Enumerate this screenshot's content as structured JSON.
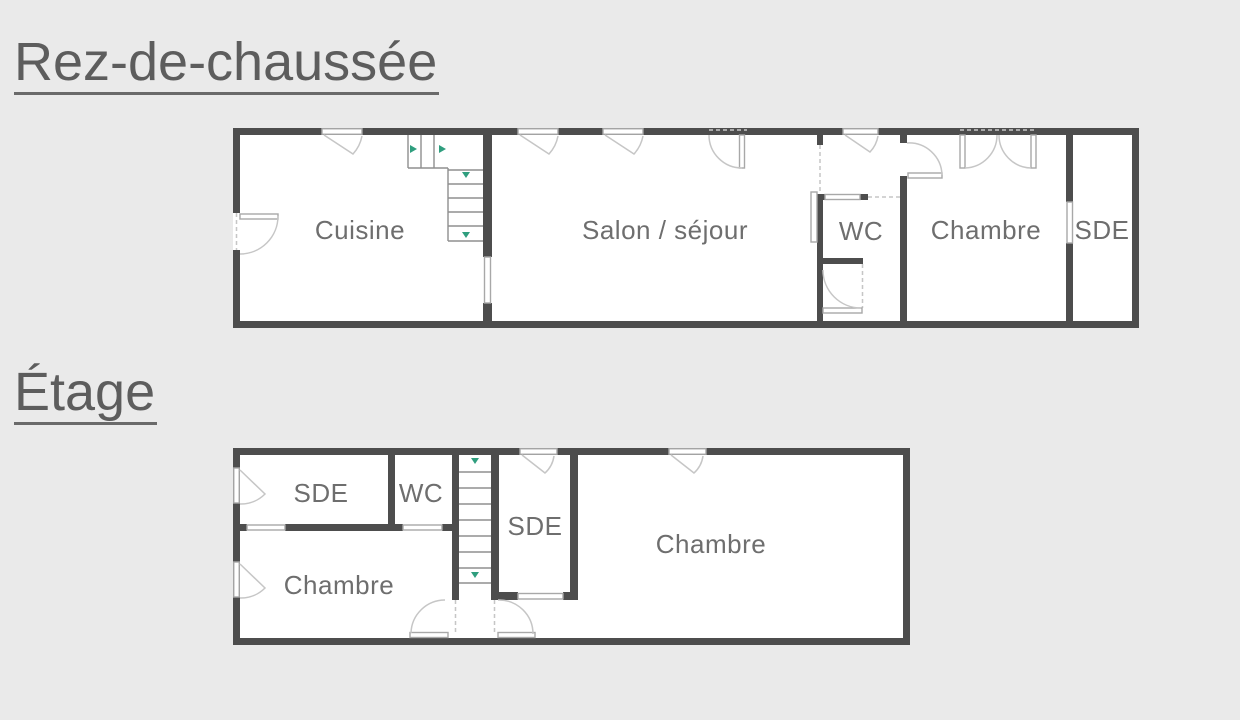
{
  "palette": {
    "background": "#eaeaea",
    "wall": "#4d4d4d",
    "room_fill": "#ffffff",
    "label_text": "#6e6e6e",
    "title_text": "#5d5d5d",
    "door_line": "#c6c6c6",
    "stair_tread": "#8f8f8f",
    "direction_arrow": "#2f9e7e",
    "window_border": "#a8a8a8"
  },
  "floors": [
    {
      "id": "ground",
      "title": "Rez-de-chaussée",
      "rooms": [
        {
          "name": "cuisine",
          "label": "Cuisine"
        },
        {
          "name": "salon-sejour",
          "label": "Salon / séjour"
        },
        {
          "name": "wc",
          "label": "WC"
        },
        {
          "name": "chambre",
          "label": "Chambre"
        },
        {
          "name": "sde",
          "label": "SDE"
        }
      ]
    },
    {
      "id": "upper",
      "title": "Étage",
      "rooms": [
        {
          "name": "sde-1",
          "label": "SDE"
        },
        {
          "name": "wc",
          "label": "WC"
        },
        {
          "name": "sde-2",
          "label": "SDE"
        },
        {
          "name": "chambre-1",
          "label": "Chambre"
        },
        {
          "name": "chambre-2",
          "label": "Chambre"
        }
      ]
    }
  ]
}
